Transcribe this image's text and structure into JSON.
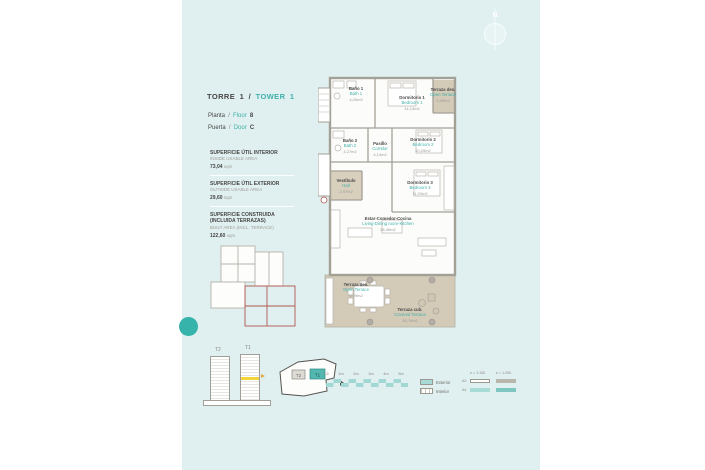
{
  "colors": {
    "panel_bg": "#e0eff0",
    "accent_teal": "#3fb0a9",
    "dark_text": "#474746",
    "gray_text": "#9c9a95",
    "terrace_tan": "#d3cab8",
    "wall_gray": "#a3a096",
    "highlight_yellow": "#f2d43c",
    "keyplan_red": "#b0584e",
    "scalebar_teal": "#a2d8d3"
  },
  "header": {
    "title_es": "TORRE 1 /",
    "title_en": "TOWER 1",
    "rows": [
      {
        "es": "Planta",
        "sep": "/",
        "en": "Floor",
        "value": "8"
      },
      {
        "es": "Puerta",
        "sep": "/",
        "en": "Door",
        "value": "C"
      }
    ]
  },
  "areas": [
    {
      "title_es": "SUPERFICIE ÚTIL INTERIOR",
      "title_en": "INSIDE USABLE AREA",
      "value": "73,04",
      "unit": "sqm"
    },
    {
      "title_es": "SUPERFICIE ÚTIL EXTERIOR",
      "title_en": "OUTSIDE USABLE AREA",
      "value": "29,60",
      "unit": "sqm"
    },
    {
      "title_es": "SUPERFICIE CONSTRUIDA (INCLUIDA TERRAZAS)",
      "title_en": "BUILT AREA (INCL. TERRACE)",
      "value": "122,60",
      "unit": "sqm"
    }
  ],
  "north_label": "N",
  "plan": {
    "rooms": [
      {
        "name_es": "Baño 1",
        "name_en": "Bath 1",
        "area": "4,00m2"
      },
      {
        "name_es": "Dormitorio 1",
        "name_en": "Bedroom 1",
        "area": "14,13m2"
      },
      {
        "name_es": "Terraza des.",
        "name_en": "Open Terrace",
        "area": "2,00m2"
      },
      {
        "name_es": "Baño 2",
        "name_en": "Bath 2",
        "area": "4,27m2"
      },
      {
        "name_es": "Pasillo",
        "name_en": "Corridor",
        "area": "4,14m2"
      },
      {
        "name_es": "Dormitorio 2",
        "name_en": "Bedroom 2",
        "area": "10,25m2"
      },
      {
        "name_es": "Vestíbulo",
        "name_en": "Hall",
        "area": "2,97m2"
      },
      {
        "name_es": "Dormitorio 3",
        "name_en": "Bedroom 3",
        "area": "11,03m2"
      },
      {
        "name_es": "Estar-Comedor-Cocina",
        "name_en": "Living-Dining room-Kitchen",
        "area": "28,36m2"
      },
      {
        "name_es": "Terraza des.",
        "name_en": "Open Terrace",
        "area": "6,09m2"
      },
      {
        "name_es": "Terraza cub.",
        "name_en": "Covered Terrace",
        "area": "18,76m2"
      }
    ]
  },
  "keyplan_towers": [
    {
      "label": "T2"
    },
    {
      "label": "T1"
    }
  ],
  "siteplan_towers": [
    {
      "label": "T2"
    },
    {
      "label": "T1"
    }
  ],
  "scalebar_ticks": [
    "0,5",
    "1m",
    "2m",
    "3m",
    "4m",
    "5m"
  ],
  "legend": {
    "items": [
      {
        "label": "Exterior"
      },
      {
        "label": "Interior"
      }
    ]
  },
  "scale_table": {
    "headers": [
      "e = 1:100",
      "e = 1:200"
    ],
    "rows": [
      {
        "label": "A3"
      },
      {
        "label": "A4"
      }
    ]
  }
}
